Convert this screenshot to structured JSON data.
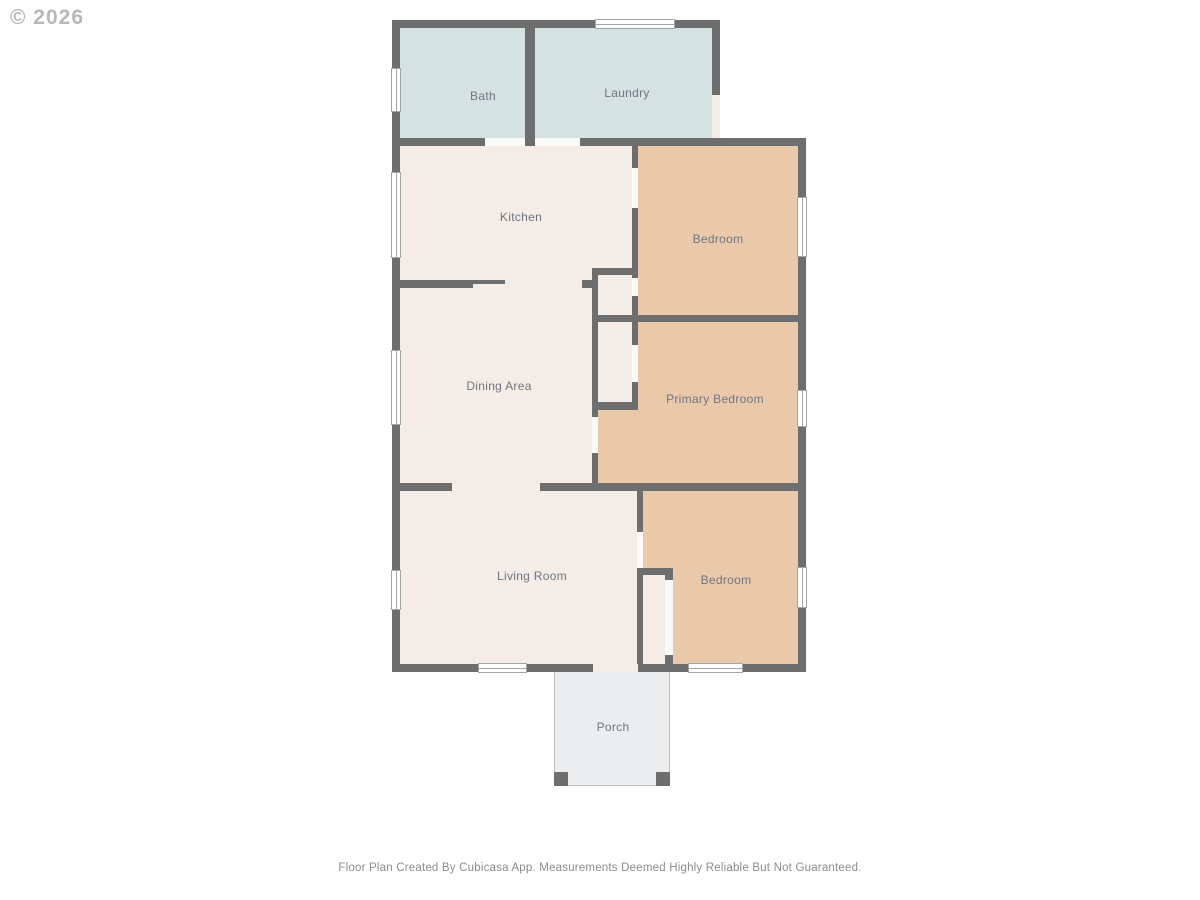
{
  "watermark": "© 2026",
  "footer": "Floor Plan Created By Cubicasa App. Measurements Deemed Highly Reliable But Not Guaranteed.",
  "palette": {
    "wall": "#6e6e6e",
    "wet": "#d4e2e1",
    "dry": "#f4ece6",
    "bedroom": "#eac9ab",
    "door": "#fbfaf8",
    "porch": "#ebedee",
    "porch_border": "#bcc0c2",
    "window_fill": "#ffffff",
    "window_border": "#a0a5a8",
    "label": "#6f7580"
  },
  "floorplan": {
    "rooms": [
      {
        "name": "main-interior",
        "fill": "dry",
        "x": 400,
        "y": 146,
        "w": 398,
        "h": 518
      },
      {
        "name": "bedroom-top",
        "fill": "bedroom",
        "x": 638,
        "y": 146,
        "w": 160,
        "h": 169
      },
      {
        "name": "primary-bedroom",
        "fill": "bedroom",
        "x": 598,
        "y": 322,
        "w": 200,
        "h": 161
      },
      {
        "name": "bedroom-bottom",
        "fill": "bedroom",
        "x": 643,
        "y": 491,
        "w": 155,
        "h": 173
      },
      {
        "name": "closet-top",
        "fill": "dry",
        "x": 598,
        "y": 275,
        "w": 34,
        "h": 40
      },
      {
        "name": "closet-primary",
        "fill": "dry",
        "x": 598,
        "y": 322,
        "w": 34,
        "h": 80
      },
      {
        "name": "closet-bottom",
        "fill": "dry",
        "x": 643,
        "y": 575,
        "w": 24,
        "h": 89
      },
      {
        "name": "bath",
        "fill": "wet",
        "x": 400,
        "y": 28,
        "w": 125,
        "h": 110
      },
      {
        "name": "laundry",
        "fill": "wet",
        "x": 535,
        "y": 28,
        "w": 177,
        "h": 110
      }
    ],
    "walls": [
      [
        392,
        20,
        8,
        652
      ],
      [
        392,
        20,
        328,
        8
      ],
      [
        712,
        20,
        8,
        75
      ],
      [
        392,
        138,
        93,
        8
      ],
      [
        525,
        138,
        10,
        8
      ],
      [
        580,
        138,
        226,
        8
      ],
      [
        798,
        146,
        8,
        526
      ],
      [
        392,
        664,
        201,
        8
      ],
      [
        638,
        664,
        168,
        8
      ],
      [
        525,
        28,
        10,
        110
      ],
      [
        397,
        280,
        76,
        8
      ],
      [
        473,
        280,
        32,
        4
      ],
      [
        582,
        280,
        10,
        8
      ],
      [
        592,
        268,
        46,
        7
      ],
      [
        592,
        268,
        6,
        149
      ],
      [
        592,
        453,
        6,
        38
      ],
      [
        632,
        146,
        6,
        22
      ],
      [
        632,
        208,
        6,
        70
      ],
      [
        632,
        296,
        6,
        49
      ],
      [
        632,
        382,
        6,
        28
      ],
      [
        595,
        315,
        211,
        7
      ],
      [
        592,
        402,
        46,
        8
      ],
      [
        397,
        483,
        55,
        8
      ],
      [
        540,
        483,
        266,
        8
      ],
      [
        637,
        491,
        6,
        41
      ],
      [
        637,
        568,
        6,
        104
      ],
      [
        637,
        568,
        35,
        7
      ],
      [
        665,
        568,
        8,
        12
      ],
      [
        665,
        655,
        8,
        17
      ]
    ],
    "doors": [
      {
        "x": 485,
        "y": 138,
        "w": 40,
        "h": 8,
        "fill": "door"
      },
      {
        "x": 535,
        "y": 138,
        "w": 45,
        "h": 8,
        "fill": "door"
      },
      {
        "x": 712,
        "y": 95,
        "w": 8,
        "h": 43,
        "fill": "dry"
      },
      {
        "x": 632,
        "y": 168,
        "w": 6,
        "h": 40,
        "fill": "door"
      },
      {
        "x": 632,
        "y": 278,
        "w": 6,
        "h": 18,
        "fill": "door"
      },
      {
        "x": 632,
        "y": 345,
        "w": 6,
        "h": 37,
        "fill": "door"
      },
      {
        "x": 592,
        "y": 417,
        "w": 6,
        "h": 36,
        "fill": "door"
      },
      {
        "x": 637,
        "y": 532,
        "w": 6,
        "h": 36,
        "fill": "door"
      },
      {
        "x": 665,
        "y": 580,
        "w": 8,
        "h": 75,
        "fill": "door"
      },
      {
        "x": 593,
        "y": 664,
        "w": 45,
        "h": 8,
        "fill": "dry"
      }
    ],
    "windows": [
      {
        "x": 391,
        "y": 68,
        "w": 10,
        "h": 44,
        "orient": "v"
      },
      {
        "x": 391,
        "y": 172,
        "w": 10,
        "h": 86,
        "orient": "v"
      },
      {
        "x": 391,
        "y": 350,
        "w": 10,
        "h": 75,
        "orient": "v"
      },
      {
        "x": 391,
        "y": 570,
        "w": 10,
        "h": 40,
        "orient": "v"
      },
      {
        "x": 595,
        "y": 19,
        "w": 80,
        "h": 10,
        "orient": "h"
      },
      {
        "x": 797,
        "y": 197,
        "w": 10,
        "h": 60,
        "orient": "v"
      },
      {
        "x": 797,
        "y": 390,
        "w": 10,
        "h": 37,
        "orient": "v"
      },
      {
        "x": 797,
        "y": 567,
        "w": 10,
        "h": 41,
        "orient": "v"
      },
      {
        "x": 478,
        "y": 663,
        "w": 49,
        "h": 10,
        "orient": "h"
      },
      {
        "x": 688,
        "y": 663,
        "w": 55,
        "h": 10,
        "orient": "h"
      }
    ],
    "porch": {
      "x": 554,
      "y": 672,
      "w": 116,
      "h": 114,
      "posts": [
        [
          554,
          772,
          14,
          14
        ],
        [
          656,
          772,
          14,
          14
        ]
      ]
    },
    "labels": [
      {
        "name": "bath",
        "text": "Bath",
        "x": 483,
        "y": 96
      },
      {
        "name": "laundry",
        "text": "Laundry",
        "x": 627,
        "y": 93
      },
      {
        "name": "kitchen",
        "text": "Kitchen",
        "x": 521,
        "y": 217
      },
      {
        "name": "bedroom-top",
        "text": "Bedroom",
        "x": 718,
        "y": 239
      },
      {
        "name": "dining-area",
        "text": "Dining Area",
        "x": 499,
        "y": 386
      },
      {
        "name": "primary-bedroom",
        "text": "Primary Bedroom",
        "x": 715,
        "y": 399
      },
      {
        "name": "living-room",
        "text": "Living Room",
        "x": 532,
        "y": 576
      },
      {
        "name": "bedroom-bottom",
        "text": "Bedroom",
        "x": 726,
        "y": 580
      },
      {
        "name": "porch",
        "text": "Porch",
        "x": 613,
        "y": 727
      }
    ]
  }
}
